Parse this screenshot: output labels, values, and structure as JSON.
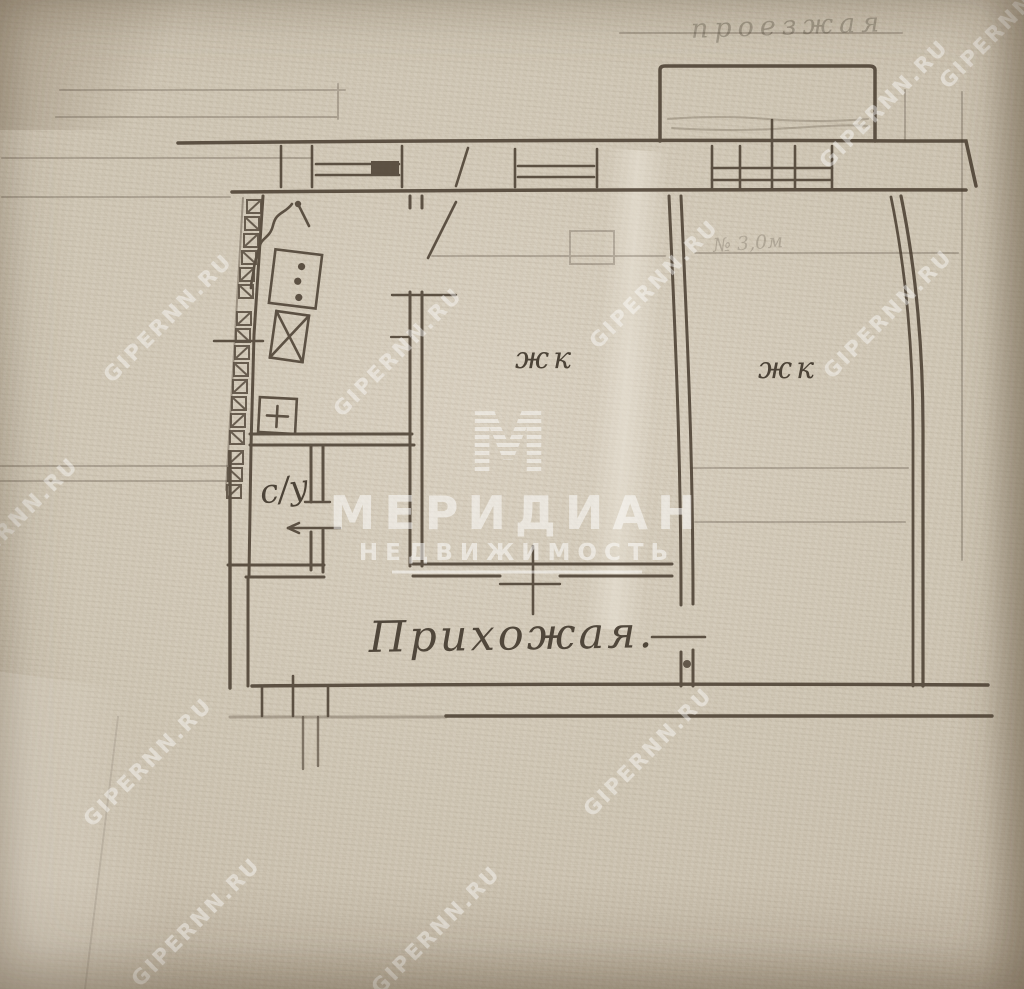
{
  "plan": {
    "rooms": [
      {
        "label": "жк"
      },
      {
        "label": "жк"
      },
      {
        "label": "с/у"
      },
      {
        "label": "Прихожая."
      }
    ],
    "faint_top_text": "проезжая",
    "faint_note": "№ 3,0м"
  },
  "watermark": {
    "site": "GIPERNN.RU",
    "brand": "МЕРИДИАН",
    "brand_sub": "НЕДВИЖИМОСТЬ",
    "logo_letter": "М"
  },
  "colors": {
    "paper": "#cfc6b4",
    "ink": "#473c2f",
    "watermark": "#ffffff"
  }
}
